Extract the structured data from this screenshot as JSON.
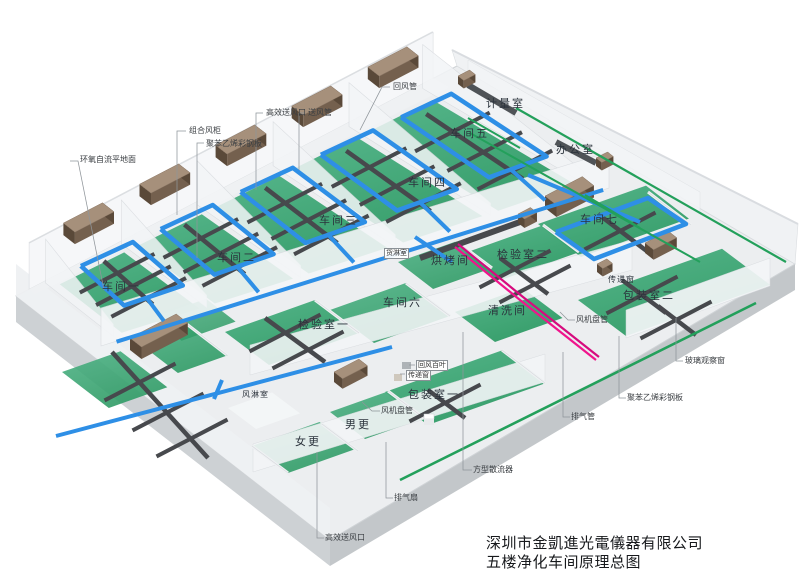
{
  "title": {
    "company": "深圳市金凱進光電儀器有限公司",
    "drawing": "五楼净化车间原理总图"
  },
  "rooms": {
    "workshop1": "车间一",
    "workshop2": "车间二",
    "workshop3": "车间三",
    "workshop4": "车间四",
    "workshop5": "车间五",
    "workshop6": "车间六",
    "workshop7": "车间七",
    "metering": "计量室",
    "office": "办公室",
    "inspection1": "检验室一",
    "inspection2": "检验室二",
    "baking": "烘烤间",
    "cleaning": "清洗间",
    "cargo_shower": "货淋室",
    "air_shower": "风淋室",
    "packing1": "包装室一",
    "packing2": "包装室二",
    "male_change": "男更",
    "female_change": "女更"
  },
  "labels": {
    "epoxy_floor": "环氧自流平地面",
    "combined_ahu": "组合风柜",
    "ps_panel": "聚苯乙烯彩钢板",
    "hepa_outlet": "高效送风口",
    "supply_duct": "送风管",
    "return_duct": "回风管",
    "return_louver": "回风百叶",
    "pass_window": "传递窗",
    "fan_coil": "风机盘管",
    "square_diffuser": "方型散流器",
    "exhaust_fan": "排气扇",
    "exhaust_pipe": "排气管",
    "glass_window": "玻璃观察窗"
  },
  "colors": {
    "duct_blue": "#2e8fe6",
    "duct_gray": "#47494d",
    "floor_green_light": "#4db285",
    "floor_green_dark": "#2e9a64",
    "corridor_green": "#23a05b",
    "ahu_top": "#a6907b",
    "ahu_front": "#74604e",
    "ahu_side": "#5a4939",
    "exhaust_magenta": "#f0148c",
    "exhaust_magenta2": "#d60b7e",
    "slab_top": "#eceef0",
    "slab_side": "#cdd1d4",
    "wall": "#f4f6f8",
    "wall_edge": "#d7dade",
    "leader": "#8f959a",
    "title_text": "#17191c"
  }
}
